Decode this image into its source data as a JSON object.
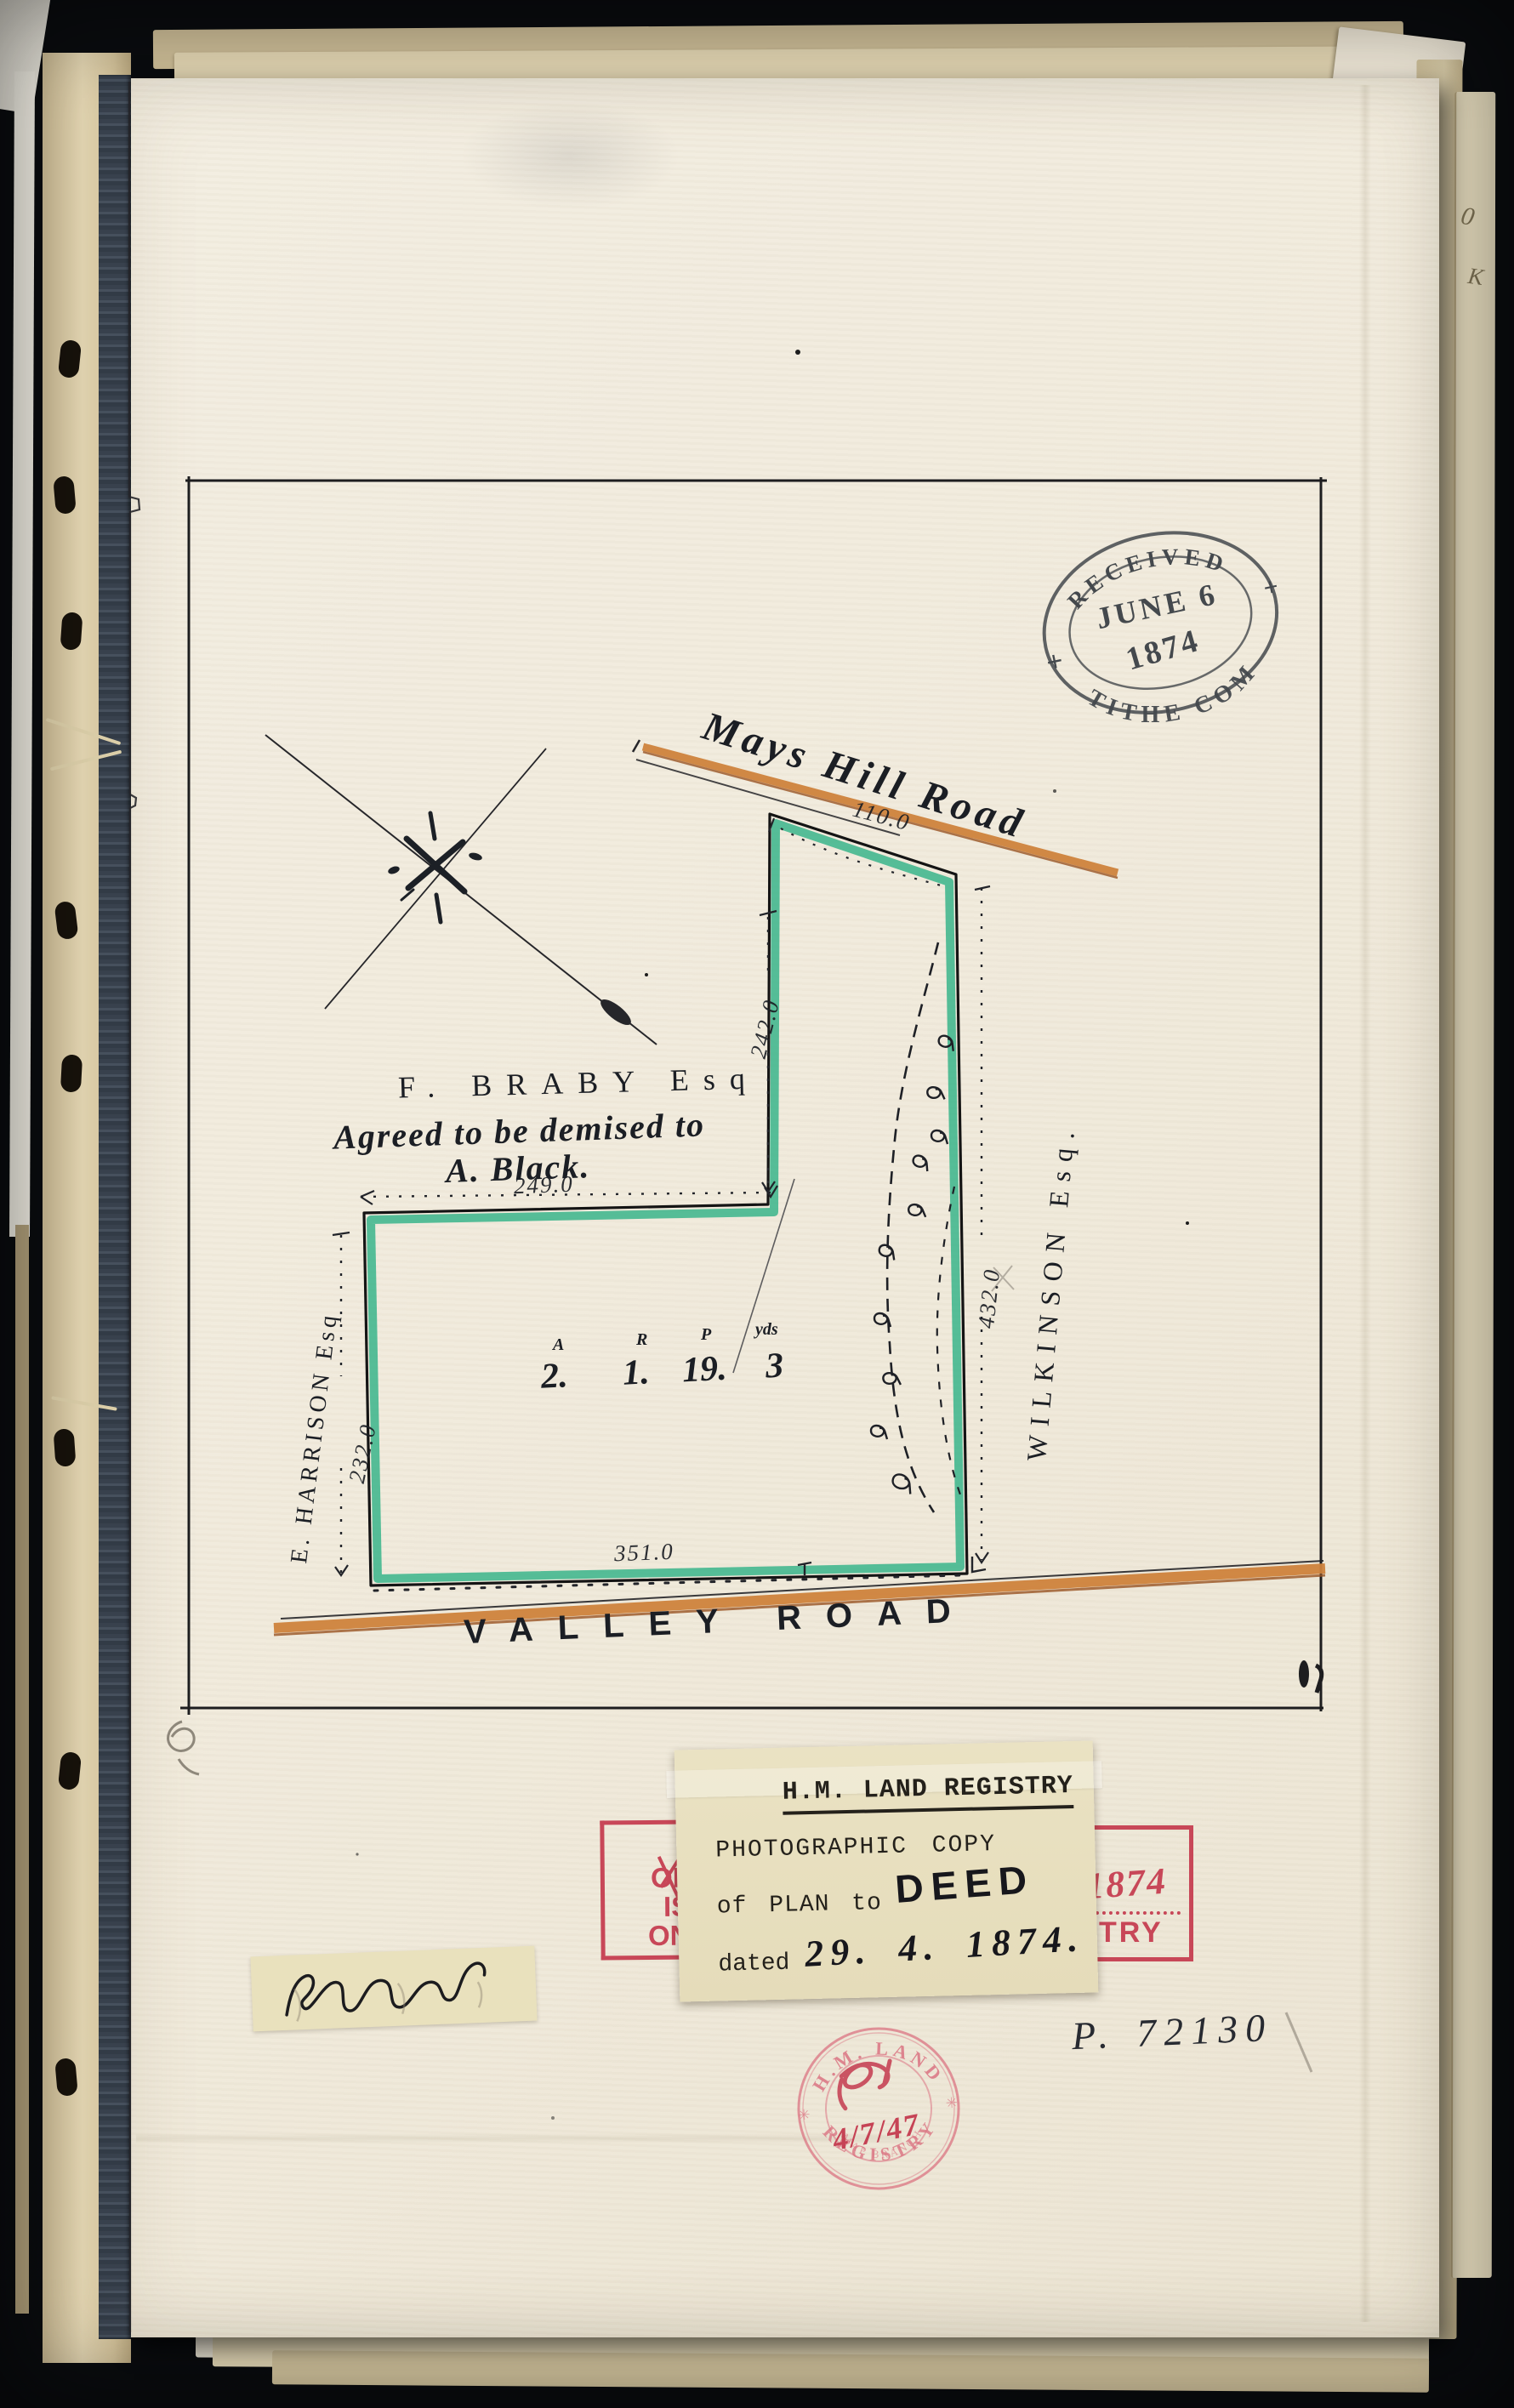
{
  "received_stamp": {
    "arc_top": "RECEIVED",
    "line_date": "JUNE 6",
    "line_year": "1874",
    "arc_bottom": "TITHE COM",
    "cross": "+"
  },
  "plan": {
    "road_top": "Mays Hill Road",
    "dim_road": "110.0",
    "owner_top": "F. BRABY Esq",
    "note_line1": "Agreed to be demised to",
    "note_line2": "A. Black.",
    "dim_step": "249.0",
    "dim_arm": "242.0",
    "dim_west": "232.0",
    "dim_east": "432.0",
    "dim_south": "351.0",
    "owner_west": "E. HARRISON Esq",
    "owner_east": "WILKINSON Esq.",
    "road_bottom": "VALLEY ROAD",
    "area": {
      "headers": [
        "A",
        "R",
        "P",
        "yds"
      ],
      "values": [
        "2.",
        "1.",
        "19.",
        "3"
      ]
    }
  },
  "label": {
    "title": "H.M. LAND REGISTRY",
    "line1": "PHOTOGRAPHIC COPY",
    "line2_prefix": "of PLAN to",
    "line2_hand": "DEED",
    "line3_prefix": "dated",
    "line3_hand": "29. 4. 1874."
  },
  "stamp_left_fragment": {
    "lines": [
      "OF",
      "IS",
      "ON"
    ]
  },
  "stamp_right_fragment": {
    "year": "1874",
    "text": "TRY"
  },
  "round_stamp": {
    "arc_top": "H.M. LAND",
    "arc_bottom": "REGISTRY",
    "sub": "MAP BRANCH",
    "date": "4/7/47",
    "star": "✳"
  },
  "reference": "P. 72130",
  "margin_marks": {
    "mark1": "0",
    "mark2": "K"
  },
  "colors": {
    "plot_green": "#2eb286",
    "road_orange": "#cf833d",
    "stamp_red": "#c53a4e",
    "round_stamp_red": "#d9687a",
    "ink": "#23282e",
    "page": "#f2ecdf"
  }
}
